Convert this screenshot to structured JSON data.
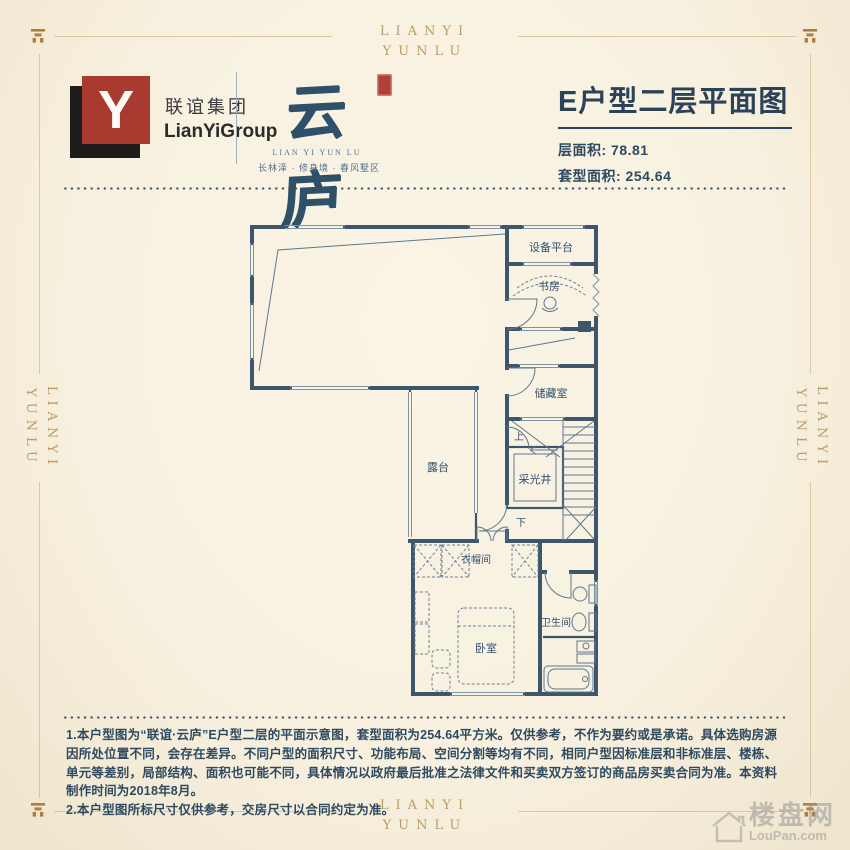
{
  "frame": {
    "word": "LIANYI\nYUNLU"
  },
  "header": {
    "logo_monogram": "Y",
    "company_cn": "联谊集团",
    "company_en": "LianYiGroup",
    "brand_name": "云庐",
    "brand_en": "LIAN YI YUN LU",
    "brand_tagline": "长林泽 · 修身境 · 春风墅区",
    "plan_title": "E户型二层平面图",
    "floor_area": "层面积: 78.81",
    "unit_area": "套型面积: 254.64"
  },
  "plan": {
    "labels": {
      "equipment_platform": "设备平台",
      "study": "书房",
      "storage": "储藏室",
      "light_well": "采光井",
      "terrace": "露台",
      "cloakroom": "衣帽间",
      "bedroom": "卧室",
      "bathroom": "卫生间",
      "stair_up": "上",
      "stair_down": "下"
    }
  },
  "footer": {
    "note1": "1.本户型图为“联谊·云庐”E户型二层的平面示意图，套型面积为254.64平方米。仅供参考，不作为要约或是承诺。具体选购房源因所处位置不同，会存在差异。不同户型的面积尺寸、功能布局、空间分割等均有不同，相同户型因标准层和非标准层、楼栋、单元等差别，局部结构、面积也可能不同，具体情况以政府最后批准之法律文件和买卖双方签订的商品房买卖合同为准。本资料制作时间为2018年8月。",
    "note2": "2.本户型图所标尺寸仅供参考，交房尺寸以合同约定为准。",
    "watermark_cn": "楼盘网",
    "watermark_en": "LouPan.com"
  },
  "colors": {
    "background": "#f8f1e0",
    "accent_gold": "#bb9c68",
    "ink_blue": "#2b4257",
    "wall_blue": "#3d566c",
    "brand_red": "#a93a30"
  }
}
